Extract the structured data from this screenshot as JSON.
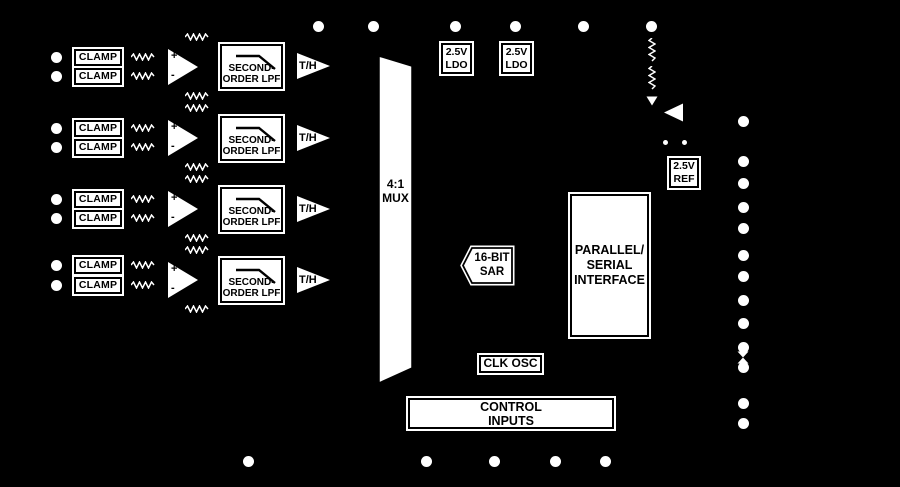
{
  "colors": {
    "background": "#000000",
    "block_fill": "#ffffff",
    "block_border": "#000000",
    "text": "#000000",
    "linework": "#ffffff"
  },
  "labels": {
    "clamp": "CLAMP",
    "amp_plus": "+",
    "amp_minus": "-",
    "lpf": [
      "SECOND-",
      "ORDER LPF"
    ],
    "th": "T/H",
    "mux": [
      "4:1",
      "MUX"
    ],
    "ldo": [
      "2.5V",
      "LDO"
    ],
    "sar": [
      "16-BIT",
      "SAR"
    ],
    "interface": [
      "PARALLEL/",
      "SERIAL",
      "INTERFACE"
    ],
    "ref": [
      "2.5V",
      "REF"
    ],
    "clk_osc": "CLK OSC",
    "control_inputs": [
      "CONTROL",
      "INPUTS"
    ]
  },
  "pins": {
    "left": {
      "x": 56,
      "ys": [
        57,
        76,
        128,
        147,
        199,
        218,
        265,
        285
      ]
    },
    "top": {
      "y": 26,
      "xs": [
        318,
        373,
        455,
        515,
        583,
        651
      ]
    },
    "right": {
      "x": 743,
      "ys": [
        121,
        161,
        183,
        207,
        228,
        255,
        276,
        300,
        323,
        347,
        367,
        403,
        423
      ]
    },
    "bottom": {
      "y": 461,
      "xs": [
        248,
        426,
        494,
        555,
        605
      ]
    }
  }
}
